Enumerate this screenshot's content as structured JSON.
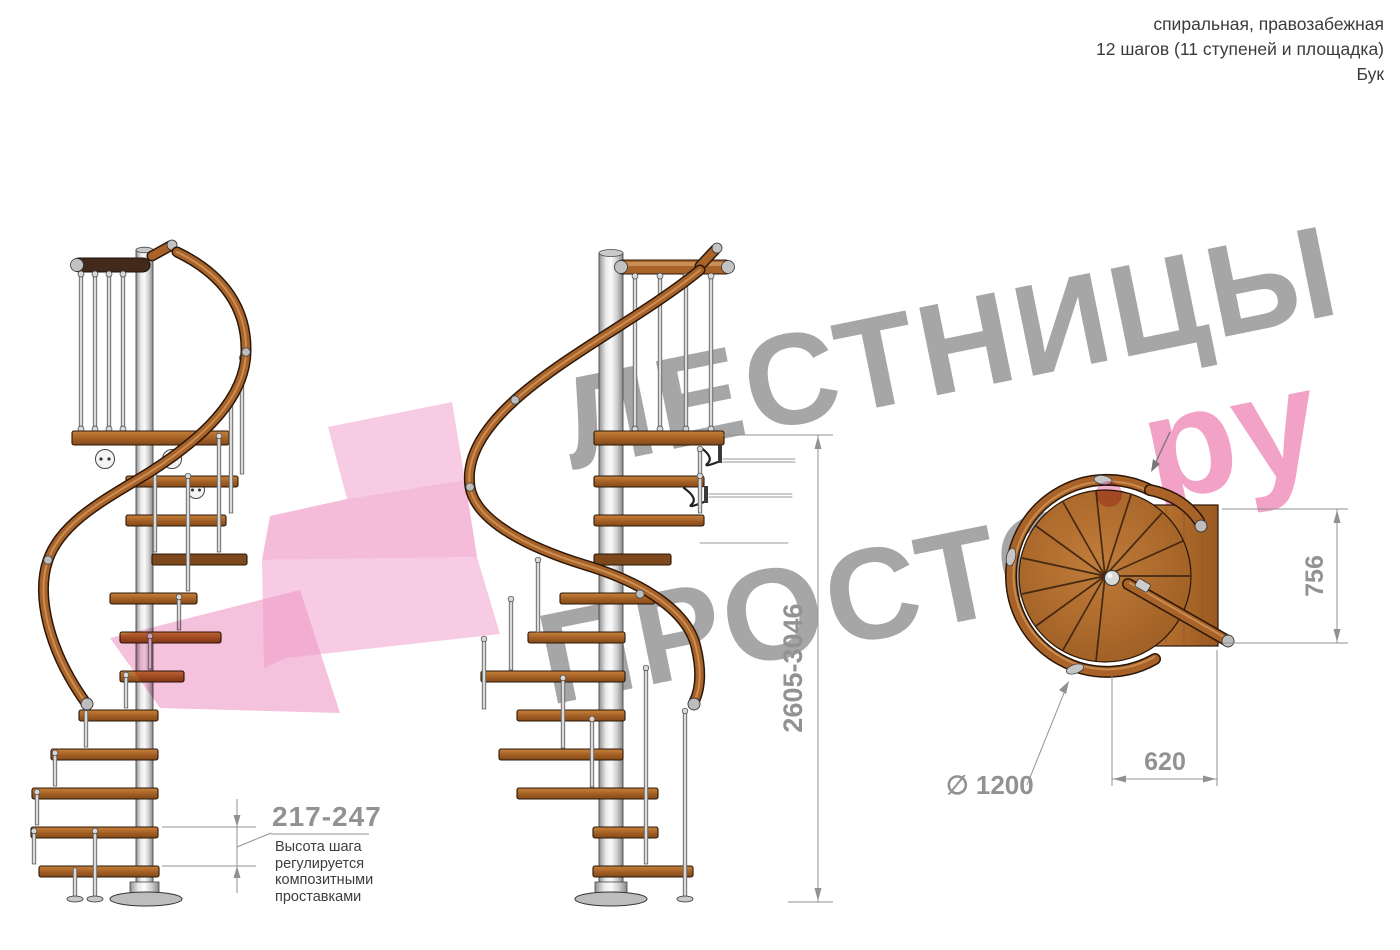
{
  "header": {
    "line1": "спиральная, правозабежная",
    "line2": "12 шагов (11 ступеней и площадка)",
    "line3": "Бук"
  },
  "watermark": {
    "line1": "ЛЕСТНИЦЫ",
    "line2": "ПРОСТО",
    "suffix": "ру",
    "gray_color": "#a6a6a6",
    "pink_color": "#f2a2c6"
  },
  "dims": {
    "total_height": "2605-3046",
    "platform_depth": "756",
    "platform_width": "620",
    "diameter": "∅ 1200",
    "step_height": "217-247",
    "note": "Высота шага\nрегулируется\nкомпозитными\nпроставками"
  },
  "colors": {
    "wood": "#b06f2e",
    "handrail": "#a96228",
    "pole": "#d9d9d9",
    "dimension": "#929292",
    "arrow_pink": "#ee9ac6"
  }
}
